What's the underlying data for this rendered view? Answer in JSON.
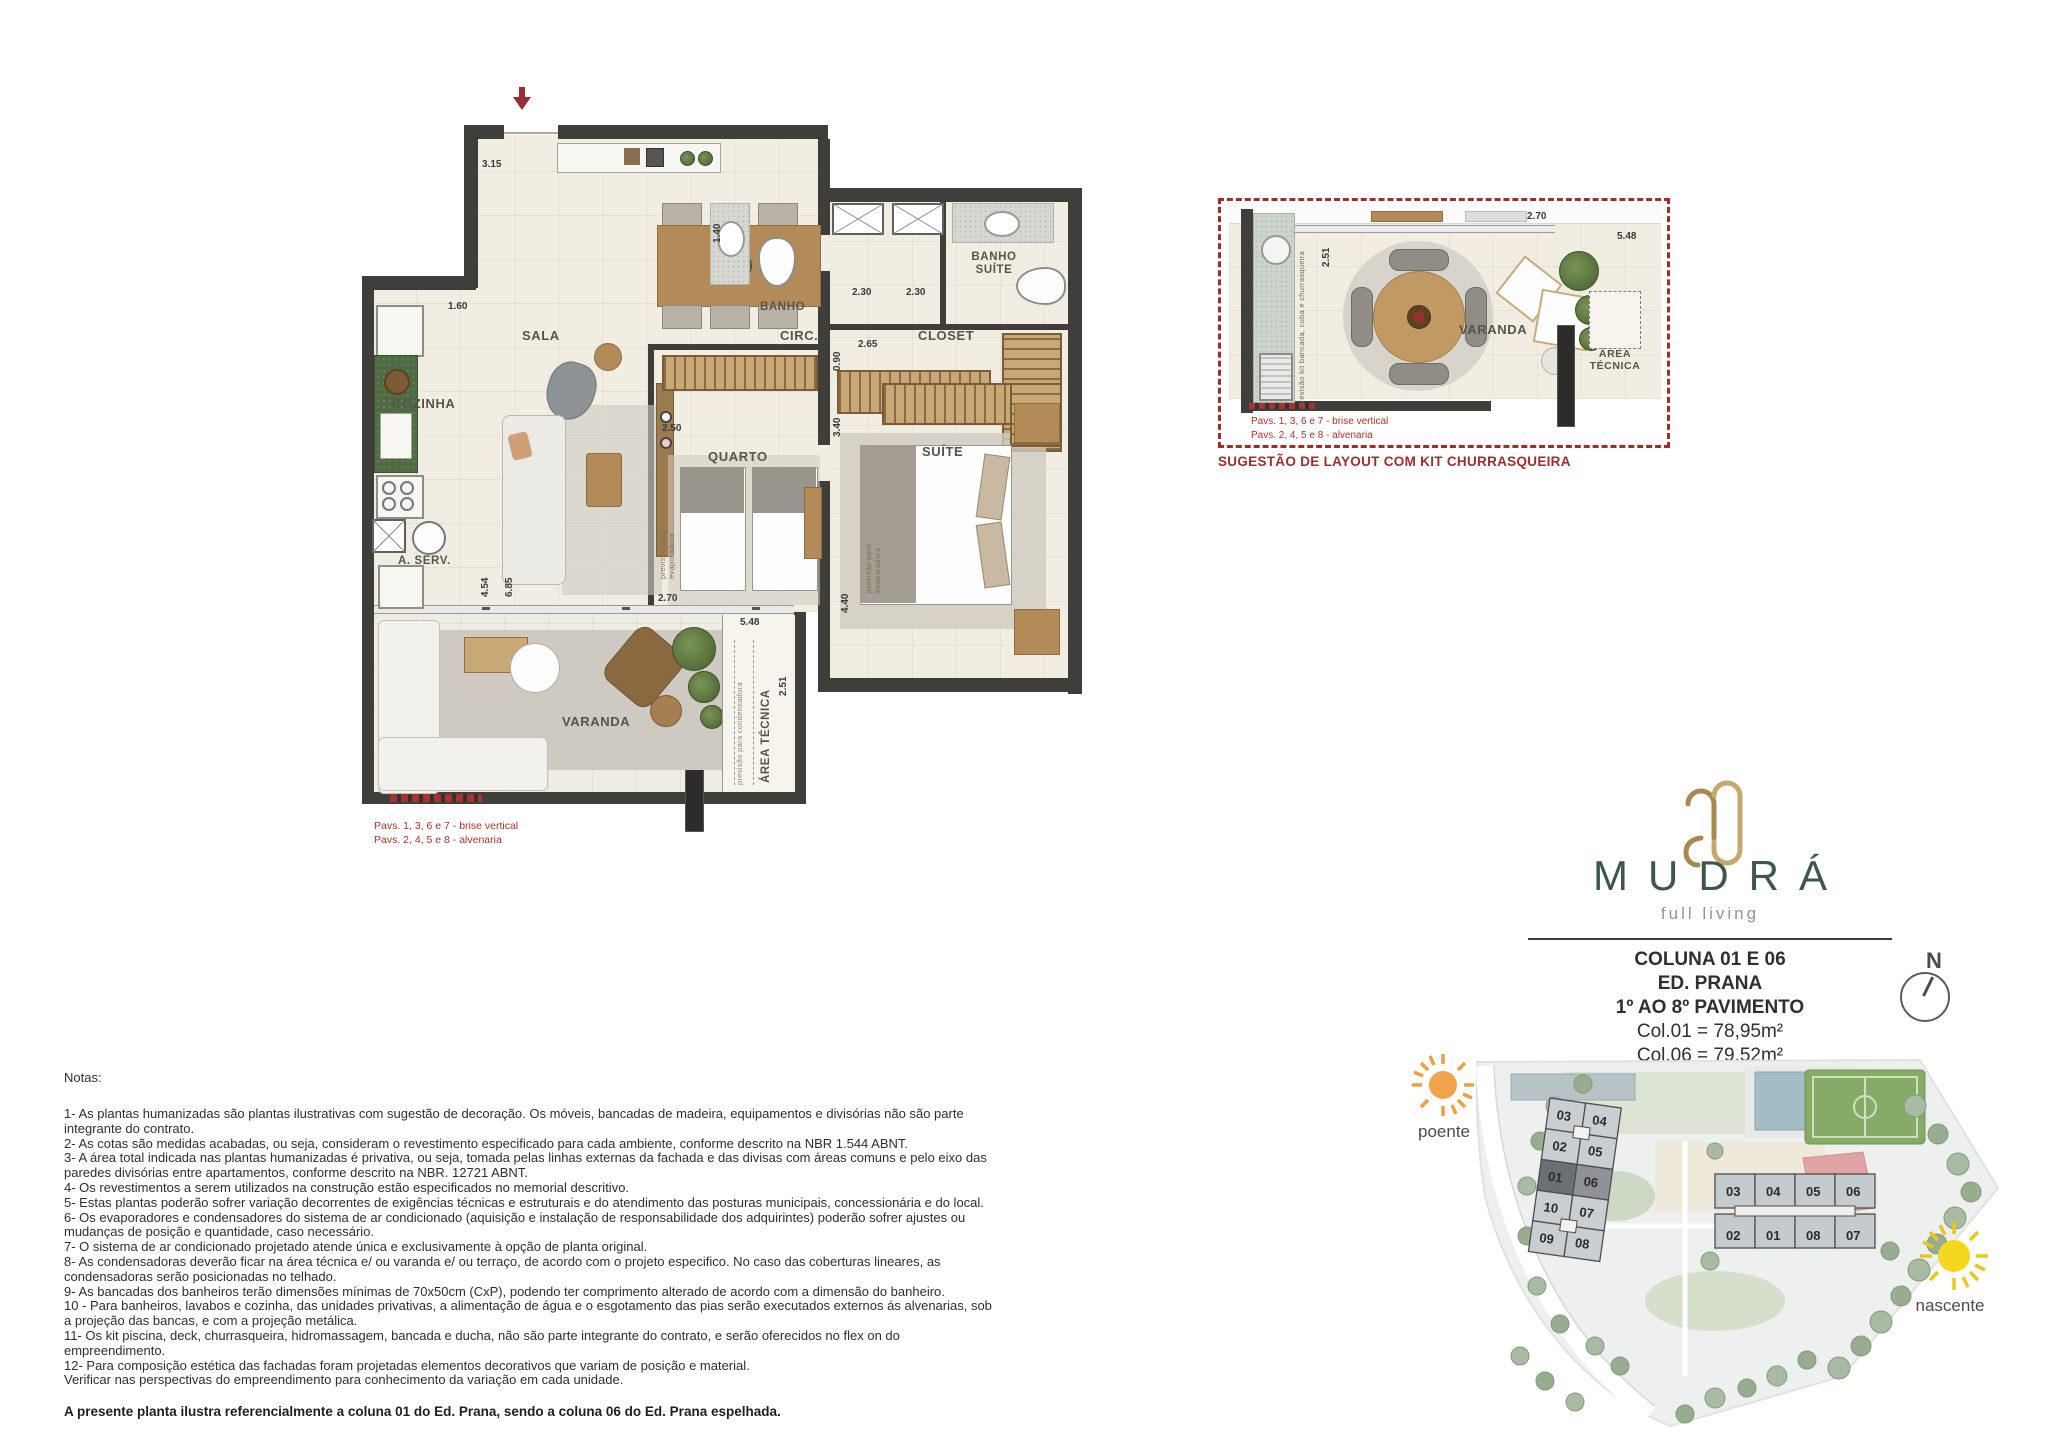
{
  "brand": {
    "wordmark": "MUDRÁ",
    "tagline": "full living"
  },
  "unit_info": {
    "coluna": "COLUNA 01 E 06",
    "edificio": "ED. PRANA",
    "pavimento": "1º AO 8º PAVIMENTO",
    "area_col01": "Col.01 = 78,95m²",
    "area_col06": "Col.06 = 79,52m²"
  },
  "compass": {
    "north": "N"
  },
  "main_plan": {
    "rooms": {
      "sala": "SALA",
      "cozinha": "COZINHA",
      "area_servico": "A. SERV.",
      "banho": "BANHO",
      "banho_suite": "BANHO SUÍTE",
      "circulacao": "CIRC.",
      "closet": "CLOSET",
      "quarto": "QUARTO",
      "suite": "SUÍTE",
      "varanda": "VARANDA",
      "area_tecnica": "ÁREA TÉCNICA"
    },
    "dims": {
      "entrada": "3.15",
      "cozinha": "1.60",
      "banho": "1.40",
      "box_banho": "2.30",
      "box_suite": "2.30",
      "circulacao": "0.90",
      "closet": "2.65",
      "quarto": "2.50",
      "quarto_prof": "3.40",
      "area_servico": "4.54",
      "sala": "6.85",
      "porta_varanda": "2.70",
      "suite": "4.40",
      "varanda": "5.48",
      "varanda_prof": "2.51"
    },
    "annotations": {
      "evaporadora_quarto": "previsão para evaporadora",
      "evaporadora_suite": "previsão para evaporadora",
      "condensadora": "previsão para condensadora"
    },
    "captions": {
      "line1": "Pavs. 1, 3, 6 e 7 - brise vertical",
      "line2": "Pavs. 2, 4, 5 e 8 - alvenaria"
    }
  },
  "suggestion_plan": {
    "title": "SUGESTÃO DE LAYOUT COM KIT CHURRASQUEIRA",
    "rooms": {
      "varanda": "VARANDA",
      "area_tecnica": "ÁREA TÉCNICA"
    },
    "dims": {
      "porta": "2.70",
      "varanda": "5.48",
      "varanda_prof": "2.51"
    },
    "annotation": "previsão kit bancada, cuba e churrasqueira",
    "captions": {
      "line1": "Pavs. 1, 3, 6 e 7 - brise vertical",
      "line2": "Pavs. 2, 4, 5 e 8 - alvenaria"
    }
  },
  "site_plan": {
    "sun_west_label": "poente",
    "sun_east_label": "nascente",
    "building_a_units": [
      "03",
      "04",
      "02",
      "05",
      "01",
      "06",
      "10",
      "07",
      "09",
      "08"
    ],
    "building_b_units": [
      "03",
      "04",
      "05",
      "06",
      "02",
      "01",
      "08",
      "07"
    ]
  },
  "notes": {
    "heading": "Notas:",
    "body": "1- As plantas humanizadas são plantas ilustrativas com sugestão de decoração. Os móveis, bancadas de madeira, equipamentos e divisórias não são parte\nintegrante do contrato.\n2- As cotas são medidas acabadas, ou seja, consideram o revestimento especificado para cada ambiente, conforme descrito na NBR 1.544 ABNT.\n3- A área total indicada nas plantas humanizadas é privativa, ou seja, tomada pelas linhas externas da fachada e das divisas com áreas comuns e pelo eixo das\nparedes divisórias entre apartamentos, conforme descrito na NBR. 12721 ABNT.\n4- Os revestimentos a serem utilizados na construção estão especificados no memorial descritivo.\n5- Estas plantas poderão sofrer variação decorrentes de exigências técnicas e estruturais e do atendimento das posturas municipais, concessionária e do local.\n6- Os evaporadores e condensadores do sistema de ar condicionado (aquisição e instalação de responsabilidade dos adquirintes) poderão sofrer ajustes ou\nmudanças de posição e quantidade, caso necessário.\n7- O sistema de ar condicionado projetado atende única e exclusivamente à opção de planta original.\n8- As condensadoras deverão ficar na área técnica e/ ou varanda e/ ou terraço, de acordo com o projeto especifico. No caso das coberturas lineares, as\ncondensadoras serão posicionadas no telhado.\n9- As bancadas dos banheiros terão dimensões mínimas de 70x50cm (CxP), podendo ter comprimento alterado de acordo com a dimensão do banheiro.\n10 - Para banheiros, lavabos e cozinha, das unidades privativas, a alimentação de água e o esgotamento das pias serão executados externos ás alvenarias, sob\na projeção das bancas, e com a projeção metálica.\n11- Os kit piscina, deck, churrasqueira, hidromassagem, bancada e ducha, não são parte integrante do contrato, e serão oferecidos no flex on do\nempreendimento.\n12- Para composição estética das fachadas foram projetadas elementos decorativos que variam de posição e material.\nVerificar nas perspectivas do empreendimento para conhecimento da variação em cada unidade.",
    "footer": "A presente planta ilustra referencialmente a coluna 01 do Ed. Prana, sendo a coluna 06 do Ed. Prana espelhada."
  },
  "colors": {
    "accent_red": "#9c2f2c",
    "logo_green": "#3e5650",
    "logo_gold": "#b5985c",
    "sun_west": "#f2a44c",
    "sun_east": "#f5d71f",
    "wall": "#403e3a",
    "highlight_unit": "#6b7075"
  }
}
